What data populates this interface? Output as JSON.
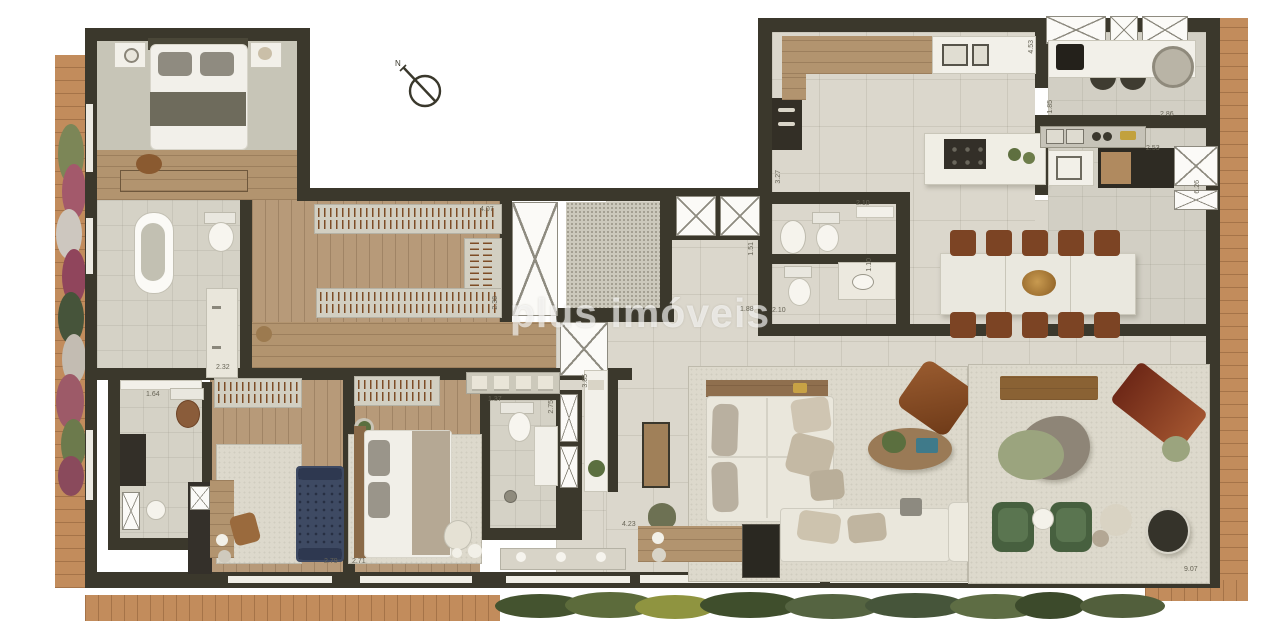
{
  "watermark": {
    "text": "plus imóveis"
  },
  "north_indicator": {
    "label": "N"
  },
  "dimension_labels": [
    {
      "text": "4.07",
      "x": 480,
      "y": 206,
      "vertical": false
    },
    {
      "text": "2.38",
      "x": 492,
      "y": 296,
      "vertical": true
    },
    {
      "text": "2.32",
      "x": 216,
      "y": 364,
      "vertical": false
    },
    {
      "text": "1.64",
      "x": 146,
      "y": 391,
      "vertical": false
    },
    {
      "text": "2.79",
      "x": 324,
      "y": 558,
      "vertical": false
    },
    {
      "text": "2.71",
      "x": 352,
      "y": 558,
      "vertical": false
    },
    {
      "text": "1.37",
      "x": 488,
      "y": 396,
      "vertical": false
    },
    {
      "text": "2.75",
      "x": 548,
      "y": 400,
      "vertical": true
    },
    {
      "text": "3.85",
      "x": 582,
      "y": 374,
      "vertical": true
    },
    {
      "text": "4.23",
      "x": 622,
      "y": 521,
      "vertical": false
    },
    {
      "text": "1.51",
      "x": 748,
      "y": 242,
      "vertical": true
    },
    {
      "text": "1.88",
      "x": 740,
      "y": 306,
      "vertical": false
    },
    {
      "text": "2.10",
      "x": 772,
      "y": 307,
      "vertical": false
    },
    {
      "text": "2.10",
      "x": 856,
      "y": 200,
      "vertical": false
    },
    {
      "text": "1.10",
      "x": 866,
      "y": 258,
      "vertical": true
    },
    {
      "text": "3.27",
      "x": 775,
      "y": 170,
      "vertical": true
    },
    {
      "text": "4.53",
      "x": 1028,
      "y": 40,
      "vertical": true
    },
    {
      "text": "1.85",
      "x": 1047,
      "y": 100,
      "vertical": true
    },
    {
      "text": "2.86",
      "x": 1160,
      "y": 111,
      "vertical": false
    },
    {
      "text": "2.53",
      "x": 1146,
      "y": 145,
      "vertical": false
    },
    {
      "text": "6.26",
      "x": 1194,
      "y": 180,
      "vertical": true
    },
    {
      "text": "9.07",
      "x": 1184,
      "y": 566,
      "vertical": false
    }
  ],
  "palette": {
    "wall": "#3b382c",
    "wood_floor": "#b79a79",
    "tile_floor": "#dbd7cc",
    "deck": "#c28c5c",
    "sofa": "#eae7dc",
    "dining_chair": "#7c4424",
    "green_armchair": "#47603f",
    "daybed_blue": "#3e4a63",
    "chaise_red": "#7e2f1a",
    "foliage": "#4c5c38"
  }
}
